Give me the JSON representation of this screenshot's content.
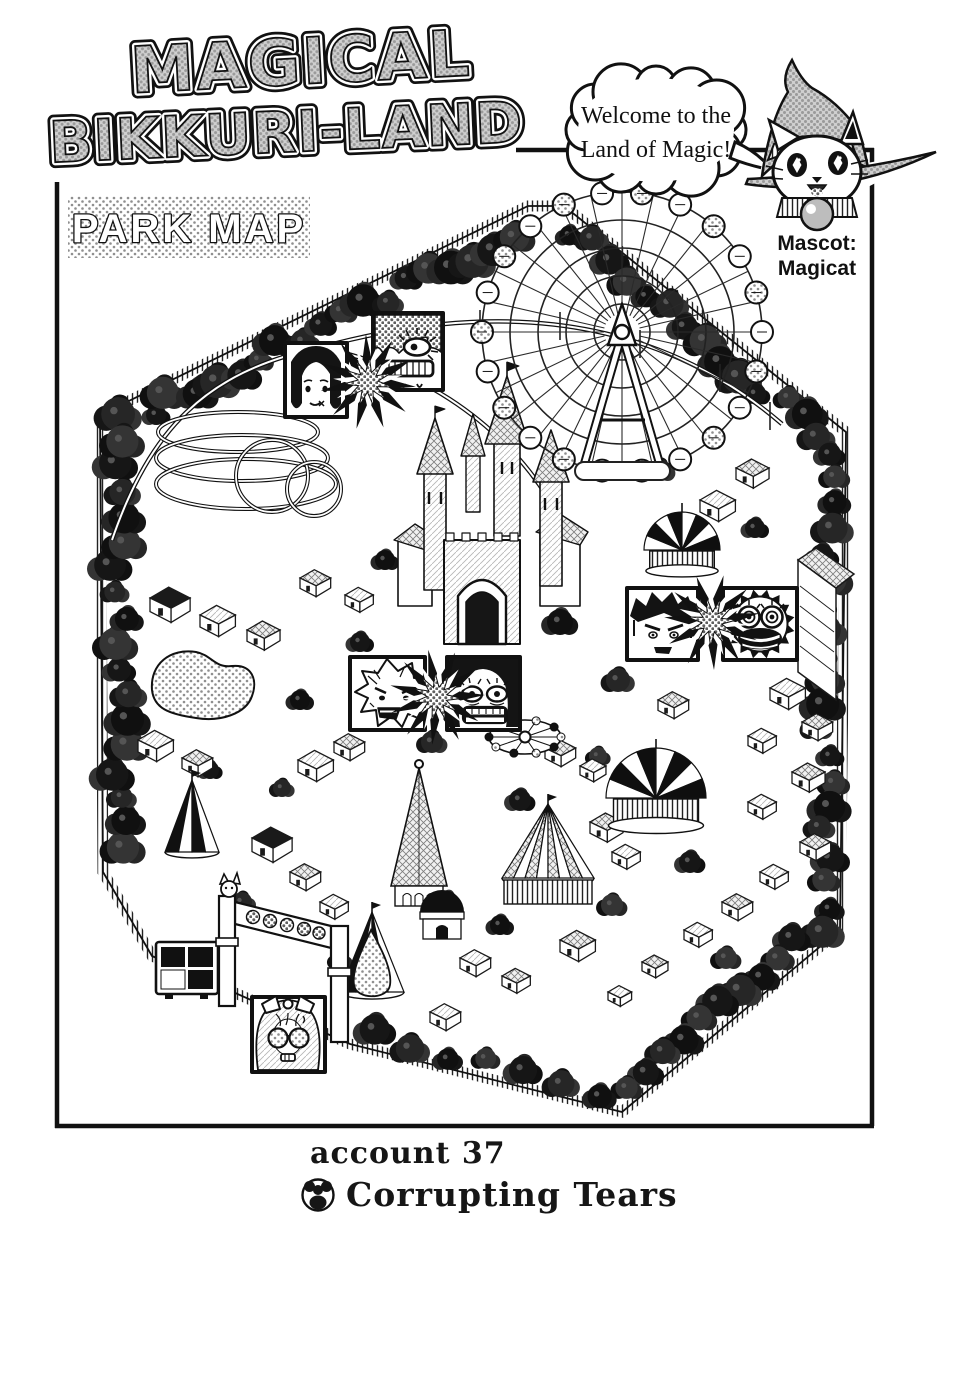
{
  "title": {
    "line1": "MAGICAL",
    "line2": "BIKKURI-LAND"
  },
  "park_map_label": "PARK MAP",
  "speech_bubble": {
    "line1": "Welcome to the",
    "line2": "Land of Magic!"
  },
  "mascot": {
    "label_line1": "Mascot:",
    "label_line2": "Magicat"
  },
  "caption": {
    "account": "account 37",
    "chapter_title": "Corrupting Tears"
  },
  "map": {
    "features": [
      "ferris-wheel",
      "roller-coaster",
      "castle",
      "pond",
      "striped-dome-carousel",
      "big-top-tent",
      "dark-tent",
      "tall-tent",
      "spinner-ride",
      "entrance-gate",
      "billboard",
      "perimeter-fence",
      "tree-border",
      "character-insets",
      "starbursts"
    ]
  },
  "colors": {
    "ink": "#111111",
    "paper": "#ffffff",
    "halftone_gray": "#9a9a9a"
  }
}
